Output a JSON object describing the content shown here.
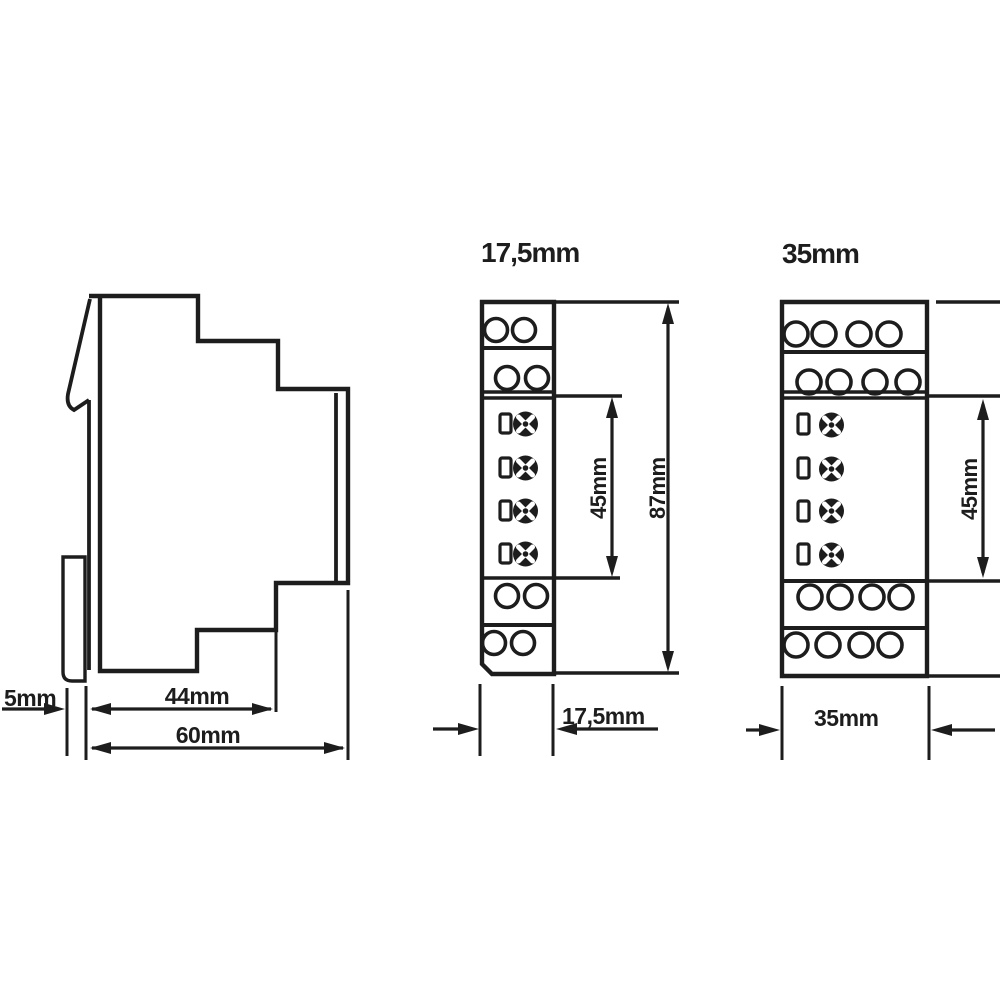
{
  "drawing": {
    "background": "#ffffff",
    "ink": "#1d1d1d",
    "side_view": {
      "name": "side-profile-of-din-rail-module",
      "dim_rail": "5mm",
      "dim_body": "44mm",
      "dim_total": "60mm"
    },
    "module_narrow": {
      "title": "17,5mm",
      "dim_body_height": "45mm",
      "dim_total_height": "87mm",
      "dim_width": "17,5mm"
    },
    "module_wide": {
      "title": "35mm",
      "dim_body_height": "45mm",
      "dim_width": "35mm"
    }
  }
}
